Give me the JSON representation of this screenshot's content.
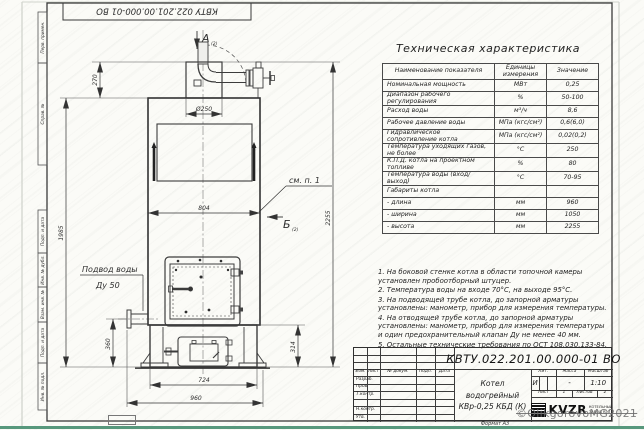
{
  "frame": {
    "top_stamp": "КВТУ 022.201.00.000-01 ВО",
    "left_labels": [
      "Перв. примен.",
      "Справ. №",
      "Подп. и дата",
      "Инв. № дубл.",
      "Взам. инв. №",
      "Подп. и дата",
      "Инв. № подл."
    ],
    "format_label": "Формат А3"
  },
  "watermark": "©OlikgorovoMG2021",
  "drawing": {
    "view_a": "А",
    "view_a_ref": "(2)",
    "view_b": "Б",
    "view_b_ref": "(2)",
    "see_note": "см. п. 1",
    "water_supply": "Подвод воды",
    "water_supply_dn": "Ду 50",
    "dims": {
      "d270": "270",
      "d250": "Ø250",
      "w804": "804",
      "h1985": "1985",
      "h2255": "2255",
      "h360": "360",
      "h314": "314",
      "w724": "724",
      "w960": "960"
    }
  },
  "spec_table": {
    "title": "Техническая характеристика",
    "headers": [
      "Наименование показателя",
      "Единицы измерения",
      "Значение"
    ],
    "rows": [
      [
        "Номинальная мощность",
        "МВт",
        "0,25"
      ],
      [
        "Диапазон рабочего регулирования",
        "%",
        "50-100"
      ],
      [
        "Расход воды",
        "м³/ч",
        "8,6"
      ],
      [
        "Рабочее давление воды",
        "МПа (кгс/см²)",
        "0,6(6,0)"
      ],
      [
        "Гидравлическое сопротивление котла",
        "МПа (кгс/см²)",
        "0,02(0,2)"
      ],
      [
        "Температура уходящих газов, не более",
        "°С",
        "250"
      ],
      [
        "К.П.Д. котла на проектном топливе",
        "%",
        "80"
      ],
      [
        "Температура воды (вход/выход)",
        "°С",
        "70-95"
      ],
      [
        "Габариты котла",
        "",
        ""
      ],
      [
        "- длина",
        "мм",
        "960"
      ],
      [
        "- ширина",
        "мм",
        "1050"
      ],
      [
        "- высота",
        "мм",
        "2255"
      ]
    ]
  },
  "notes": [
    "1. На боковой стенке котла в области топочной камеры установлен пробоотборный штуцер.",
    "2. Температура воды на входе 70°С, на выходе 95°С.",
    "3. На подводящей трубе котла, до запорной арматуры установлены: манометр, прибор для измерения температуры.",
    "4. На отводящей трубе котла, до запорной арматуры установлены: манометр, прибор для измерения температуры и один предохранительный клапан Ду не менее 40 мм.",
    "5. Остальные технические требования по ОСТ 108.030.133-84."
  ],
  "title_block": {
    "doc_number": "КВТУ.022.201.00.000-01 ВО",
    "product_name_line1": "Котел водогрейный",
    "product_name_line2": "КВр-0,25 КБД (К)",
    "col_headers": [
      "Изм.",
      "Лист",
      "№ докум.",
      "Подп.",
      "Дата"
    ],
    "row_labels": [
      "Разраб.",
      "Пров.",
      "Т.контр.",
      "Н.контр.",
      "Утв."
    ],
    "lit_label": "Лит.",
    "lit_value": "И",
    "mass_label": "Масса",
    "mass_value": "-",
    "scale_label": "Масштаб",
    "scale_value": "1:10",
    "sheet_label": "Лист",
    "sheet_value": "1",
    "sheets_label": "Листов",
    "sheets_value": "2",
    "logo_text": "KVZR",
    "company_line1": "КОТЕЛЬНЫЙ",
    "company_line2": "ЗАВОД РЭП"
  }
}
